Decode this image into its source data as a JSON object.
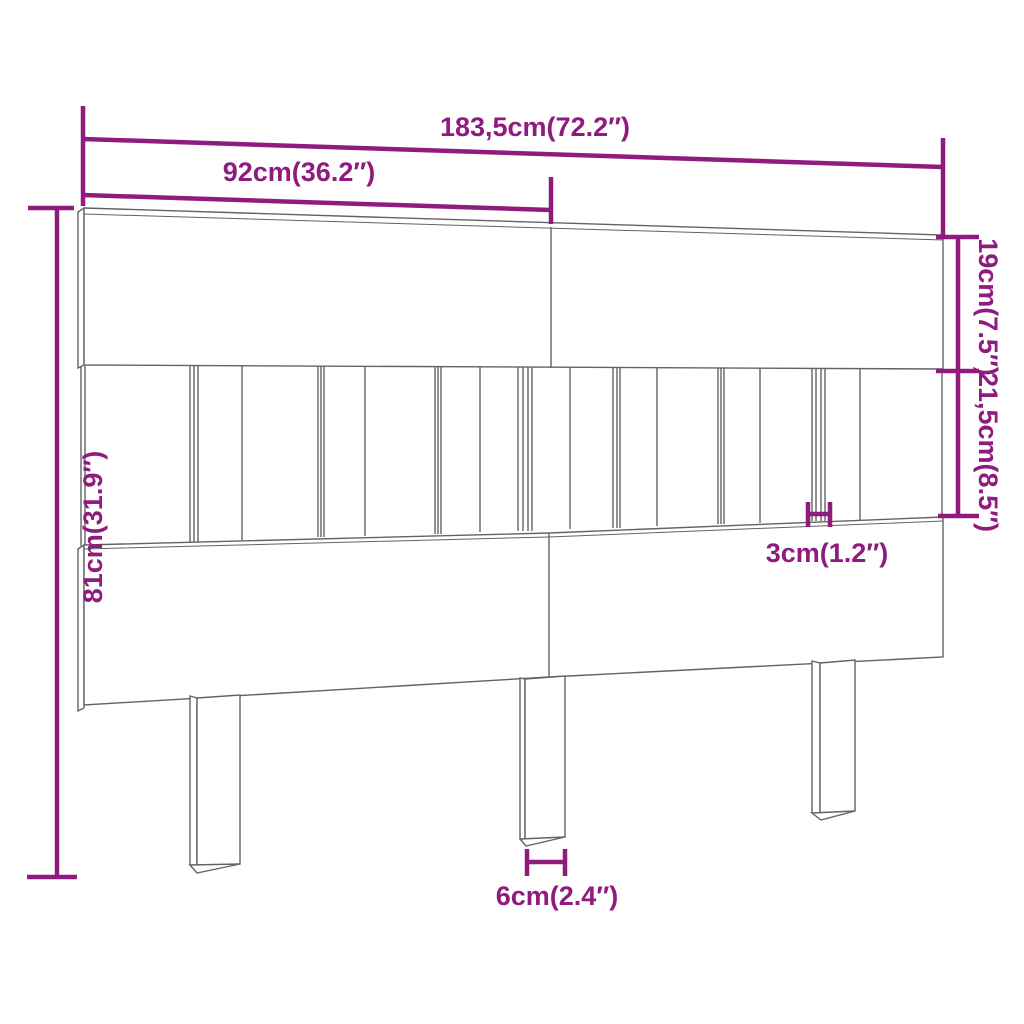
{
  "diagram": {
    "type": "furniture-dimension-diagram",
    "subject": "headboard",
    "colors": {
      "dimension_color": "#8e1b7d",
      "outline_color": "#636363",
      "background": "#ffffff"
    },
    "labels": {
      "total_width": "183,5cm(72.2″)",
      "panel_width": "92cm(36.2″)",
      "total_height": "81cm(31.9″)",
      "top_board_height": "19cm(7.5″)",
      "slat_section_height": "21,5cm(8.5″)",
      "slat_width": "3cm(1.2″)",
      "leg_width": "6cm(2.4″)"
    }
  }
}
